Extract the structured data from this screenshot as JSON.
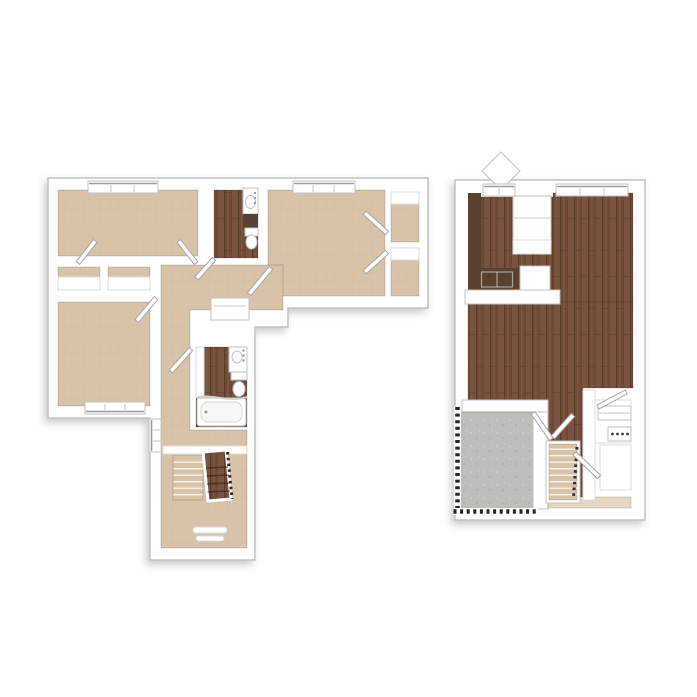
{
  "scene": {
    "background": "#ffffff",
    "kind": "3d-rendered-two-level-floor-plan"
  },
  "plans": {
    "left": {
      "name": "bedroom-level-plan",
      "rooms": [
        {
          "name": "bedroom-top-left",
          "floor": "carpet"
        },
        {
          "name": "bathroom-top",
          "floor": "wood",
          "fixtures": [
            "vanity-sink",
            "counter",
            "toilet"
          ]
        },
        {
          "name": "bedroom-top-right",
          "floor": "carpet",
          "closets": 2
        },
        {
          "name": "closets-left",
          "floor": "carpet",
          "closets": 2
        },
        {
          "name": "bedroom-bottom-left",
          "floor": "carpet"
        },
        {
          "name": "hallway",
          "floor": "carpet"
        },
        {
          "name": "linen-closet",
          "floor": "none"
        },
        {
          "name": "bathroom-middle",
          "floor": "wood",
          "fixtures": [
            "vanity-sink",
            "toilet",
            "bathtub"
          ]
        },
        {
          "name": "stair-hall",
          "floor": "carpet",
          "fixtures": [
            "staircase",
            "entry-mats"
          ]
        }
      ],
      "windows": 4,
      "doors": 8
    },
    "right": {
      "name": "main-level-plan",
      "rooms": [
        {
          "name": "kitchen",
          "floor": "wood",
          "fixtures": [
            "l-counter",
            "sink",
            "refrigerator",
            "dishwasher-counter"
          ]
        },
        {
          "name": "living-dining",
          "floor": "wood"
        },
        {
          "name": "patio",
          "floor": "concrete",
          "fixtures": [
            "fence-railing"
          ]
        },
        {
          "name": "staircase",
          "floor": "carpet-treads"
        },
        {
          "name": "laundry-closet",
          "floor": "none",
          "fixtures": [
            "shelf",
            "appliance-knobs"
          ]
        },
        {
          "name": "under-stair-closet",
          "floor": "none"
        },
        {
          "name": "entry",
          "floor": "tile"
        }
      ],
      "windows": 2,
      "doors": 4
    }
  },
  "colors": {
    "carpet": "#d8c2a8",
    "wood": "#714b36",
    "counter": "#59422f",
    "patio": "#bdbdb9",
    "tile": "#e6d8c0",
    "wall": "#ffffff",
    "wall_edge": "#c7c7c7",
    "fence": "#262626",
    "window_line": "#9c9c9c",
    "rail_dark": "#2e2e2e"
  }
}
